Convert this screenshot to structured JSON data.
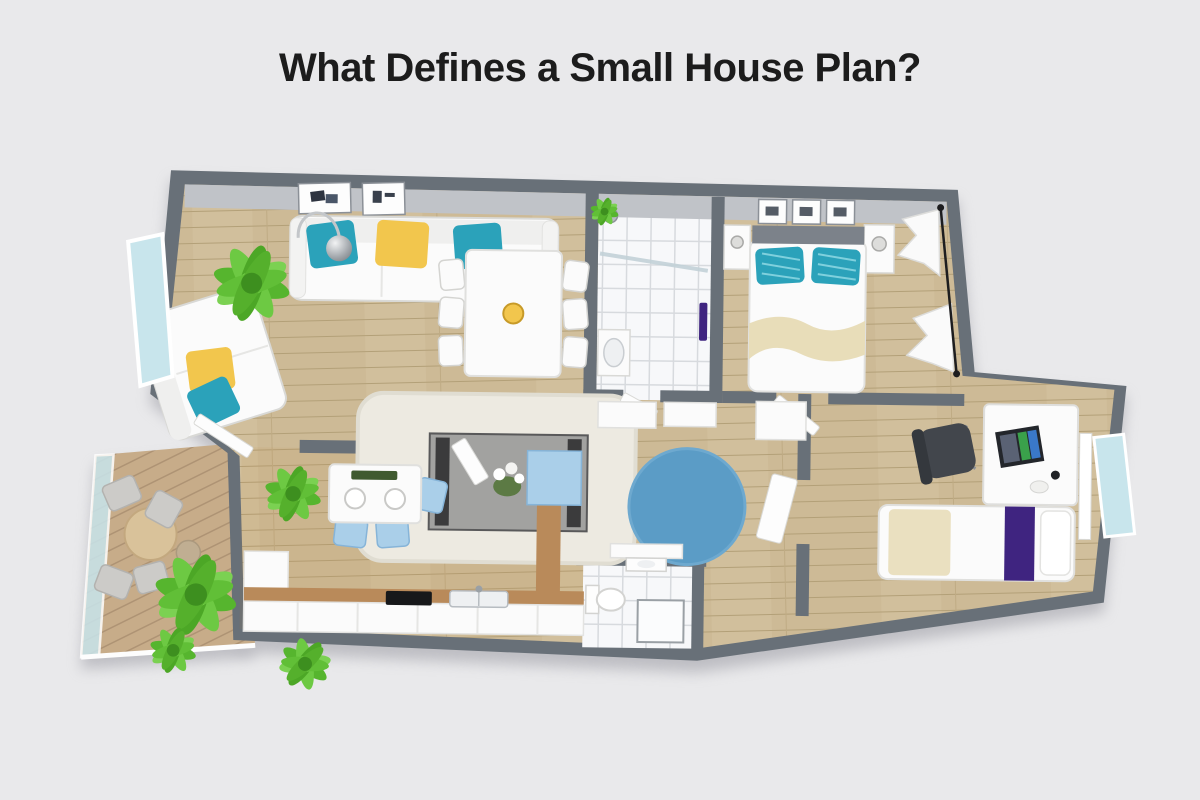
{
  "page": {
    "title": "What Defines a Small House Plan?"
  },
  "palette": {
    "bg": "#e9e9eb",
    "title_color": "#1c1c1c",
    "wall": "#687078",
    "wall_inner": "#c0c3c8",
    "wood": "#cdba96",
    "tile": "#f7f8fa",
    "tile_line": "#d7dade",
    "deck": "#c7ac89",
    "furniture_white": "#fbfbfb",
    "furniture_line": "#d9d9d6",
    "teal": "#2ba2ba",
    "yellow": "#f2c64d",
    "rug_blue": "#5b9cc6",
    "rug_cream": "#edeae1",
    "light_blue": "#aacfe9",
    "glass": "#c8e5ec",
    "purple": "#3f2480",
    "green": "#62c135",
    "tan": "#e8ddb9",
    "counter_walnut": "#b98a5a",
    "chair_gray": "#cccbc8",
    "chair_dark": "#42464c"
  },
  "floor_plan": {
    "type": "3d-rendered small apartment floor plan, top view",
    "rooms": [
      {
        "name": "living-room",
        "floor": "light oak",
        "furniture": [
          "three-seat white sofa with two teal and one yellow pillow",
          "white loveseat with yellow and teal pillows",
          "chrome arc floor lamp",
          "dark coffee table with white flowers",
          "cream shag area rug",
          "two framed wall artworks",
          "potted plant"
        ]
      },
      {
        "name": "dining-area",
        "floor": "light oak",
        "furniture": [
          "white dining table",
          "six white chairs",
          "yellow fruit bowl"
        ]
      },
      {
        "name": "bathroom",
        "floor": "white tile",
        "furniture": [
          "walk-in shower with glass divider",
          "shower head",
          "vanity sink",
          "purple towel",
          "small plant"
        ]
      },
      {
        "name": "bedroom",
        "floor": "light oak",
        "furniture": [
          "double bed with gray headboard",
          "two teal striped pillows",
          "beige throw blanket",
          "two white nightstands with lamps",
          "three framed pictures",
          "white curtains on black rod"
        ]
      },
      {
        "name": "hallway",
        "floor": "light oak",
        "furniture": [
          "round blue rug",
          "white closets",
          "open white doors"
        ]
      },
      {
        "name": "home-office-bedroom",
        "floor": "light oak",
        "furniture": [
          "white desk",
          "monitor",
          "black office chair",
          "single bed with purple runner",
          "side-hung window"
        ]
      },
      {
        "name": "kitchen",
        "floor": "light oak",
        "furniture": [
          "white breakfast table with place settings",
          "three light-blue chairs",
          "white base cabinets with walnut counter",
          "double sink",
          "black cooktop",
          "light-blue fridge cabinet",
          "potted plant"
        ]
      },
      {
        "name": "wc",
        "floor": "white tile",
        "furniture": [
          "toilet",
          "corner shower",
          "small sink"
        ]
      },
      {
        "name": "balcony",
        "floor": "wooden deck",
        "furniture": [
          "round wooden table",
          "four gray chairs",
          "glass railing",
          "two palm plants"
        ]
      }
    ]
  }
}
